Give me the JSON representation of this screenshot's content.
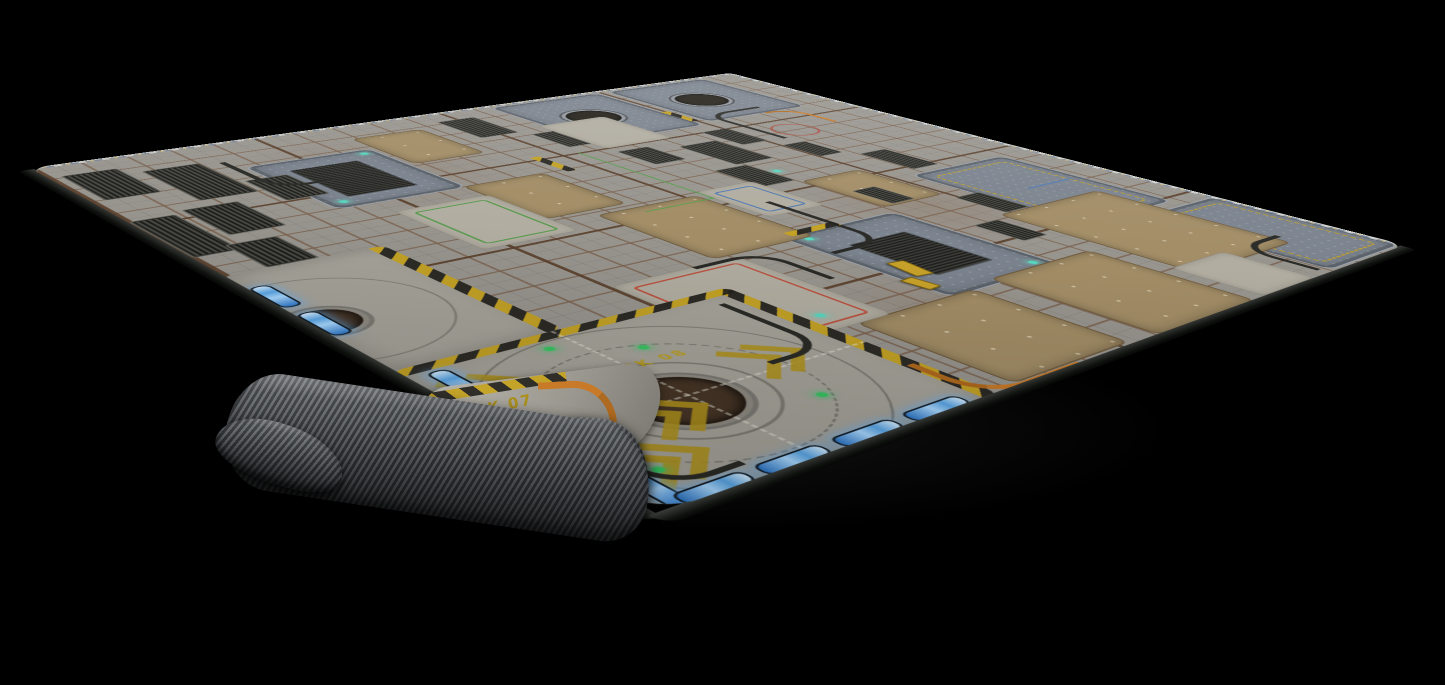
{
  "mat": {
    "markings": {
      "bay_label": "BAY",
      "bay_number": "42",
      "dock_front_label": "DOCK 08",
      "dock_left_label": "DOCK 07"
    },
    "colors": {
      "background": "#000000",
      "deck_grey": "#98958f",
      "rust_seam": "#7a5f4a",
      "hazard_yellow": "#c7a31c",
      "marking_yellow": "#b1931c",
      "pad_blue_border": "#3c6da6",
      "led_blue": "#4d9fe0",
      "indicator_green": "#39c463",
      "cable_orange": "#c87a28",
      "fabric_backing": "#4a4e52"
    }
  }
}
